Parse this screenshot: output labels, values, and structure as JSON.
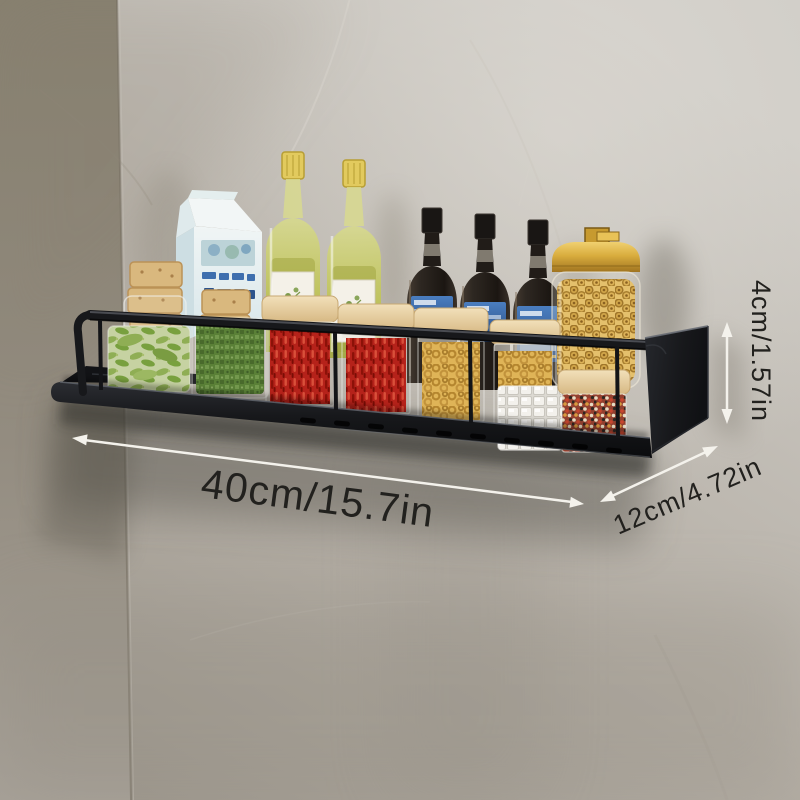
{
  "meta": {
    "image_type": "product-photo",
    "subject": "Black metal wall-mounted kitchen spice rack shelf with rail, loaded with bottles and jars, on a gray plaster wall with dimension callouts"
  },
  "dimensions": {
    "length": "40cm/15.7in",
    "depth": "12cm/4.72in",
    "height": "4cm/1.57in"
  },
  "shelf": {
    "finish": "matte black metal",
    "features": [
      "front guard rail",
      "rounded corners",
      "drain slots in base",
      "side mounting panel"
    ]
  },
  "items": [
    "glass jar with stacked crackers",
    "blue and white milk carton",
    "second glass jar with stacked crackers",
    "olive oil bottle with yellow cap",
    "second olive oil bottle with yellow cap",
    "dark sauce bottle with blue label",
    "second dark sauce bottle with blue label",
    "third dark sauce bottle with blue label",
    "round glass jar with gold lid full of pasta",
    "square jar of edamame pods",
    "square jar of dried green herb",
    "wood-lid spice jar of red chilies",
    "second wood-lid spice jar of red chilies",
    "wood-lid jar of macaroni",
    "second wood-lid jar of macaroni",
    "jar of white sugar cubes",
    "wood-lid jar of mixed peppercorns"
  ],
  "colors": {
    "wall_light": "#cfccc6",
    "wall_mid": "#b7b1a8",
    "wall_dark": "#9a948a",
    "wall_corner": "#87806f",
    "shelf_black": "#17181b",
    "shelf_edge_highlight": "#5a5e66",
    "arrow_white": "#f4f2ec",
    "dimension_text": "#22211e",
    "gold_lid": "#d9ad3e",
    "wood_lid": "#e8d3a6",
    "olive_oil_green": "#c0c45c",
    "oil_cap_yellow": "#e2ca5e",
    "sauce_bottle_dark": "#241e19",
    "sauce_label_blue": "#3563a6",
    "chili_red": "#b5221a",
    "herb_green": "#4d7627",
    "macaroni_gold": "#dfb457",
    "pasta_tan": "#e3bd66",
    "edamame_green": "#8fae54",
    "sugar_white": "#efede8",
    "milk_carton_blue": "#3f6fae"
  }
}
